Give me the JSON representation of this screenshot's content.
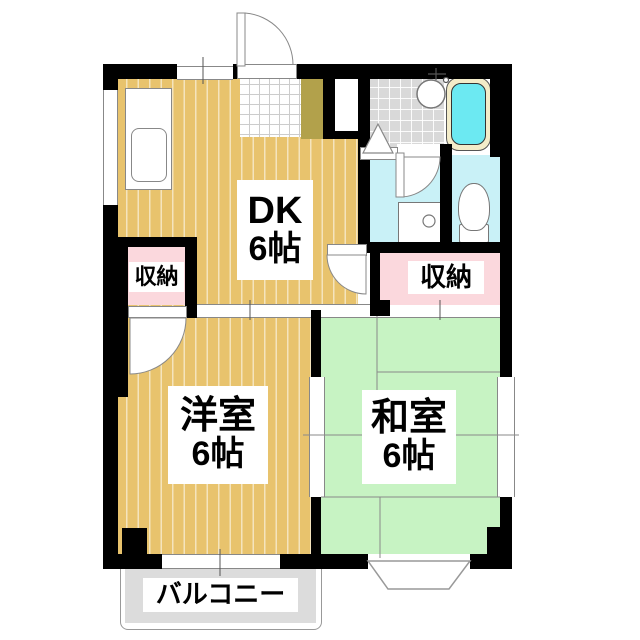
{
  "rooms": {
    "dk": {
      "name": "DK",
      "size": "6帖"
    },
    "western": {
      "name": "洋室",
      "size": "6帖"
    },
    "japanese": {
      "name": "和室",
      "size": "6帖"
    }
  },
  "closets": {
    "left": "収納",
    "right": "収納"
  },
  "balcony": {
    "label": "バルコニー"
  },
  "fixtures": [
    "kitchen-sink",
    "bathtub",
    "wash-basin",
    "washing-machine-pan",
    "toilet",
    "entrance-door"
  ],
  "colors": {
    "wood_floor": "#e8c36d",
    "tatami": "#c7f3c3",
    "water_rooms": "#c9f1f7",
    "bathtub_water": "#6ce9f2",
    "bathtub_rim": "#f3ecc9",
    "closet": "#fbd8dd",
    "shoe_cabinet": "#b2a14b",
    "bath_tile": "#d9d9d9",
    "balcony": "#dcdcdc",
    "walls": "#000000"
  }
}
